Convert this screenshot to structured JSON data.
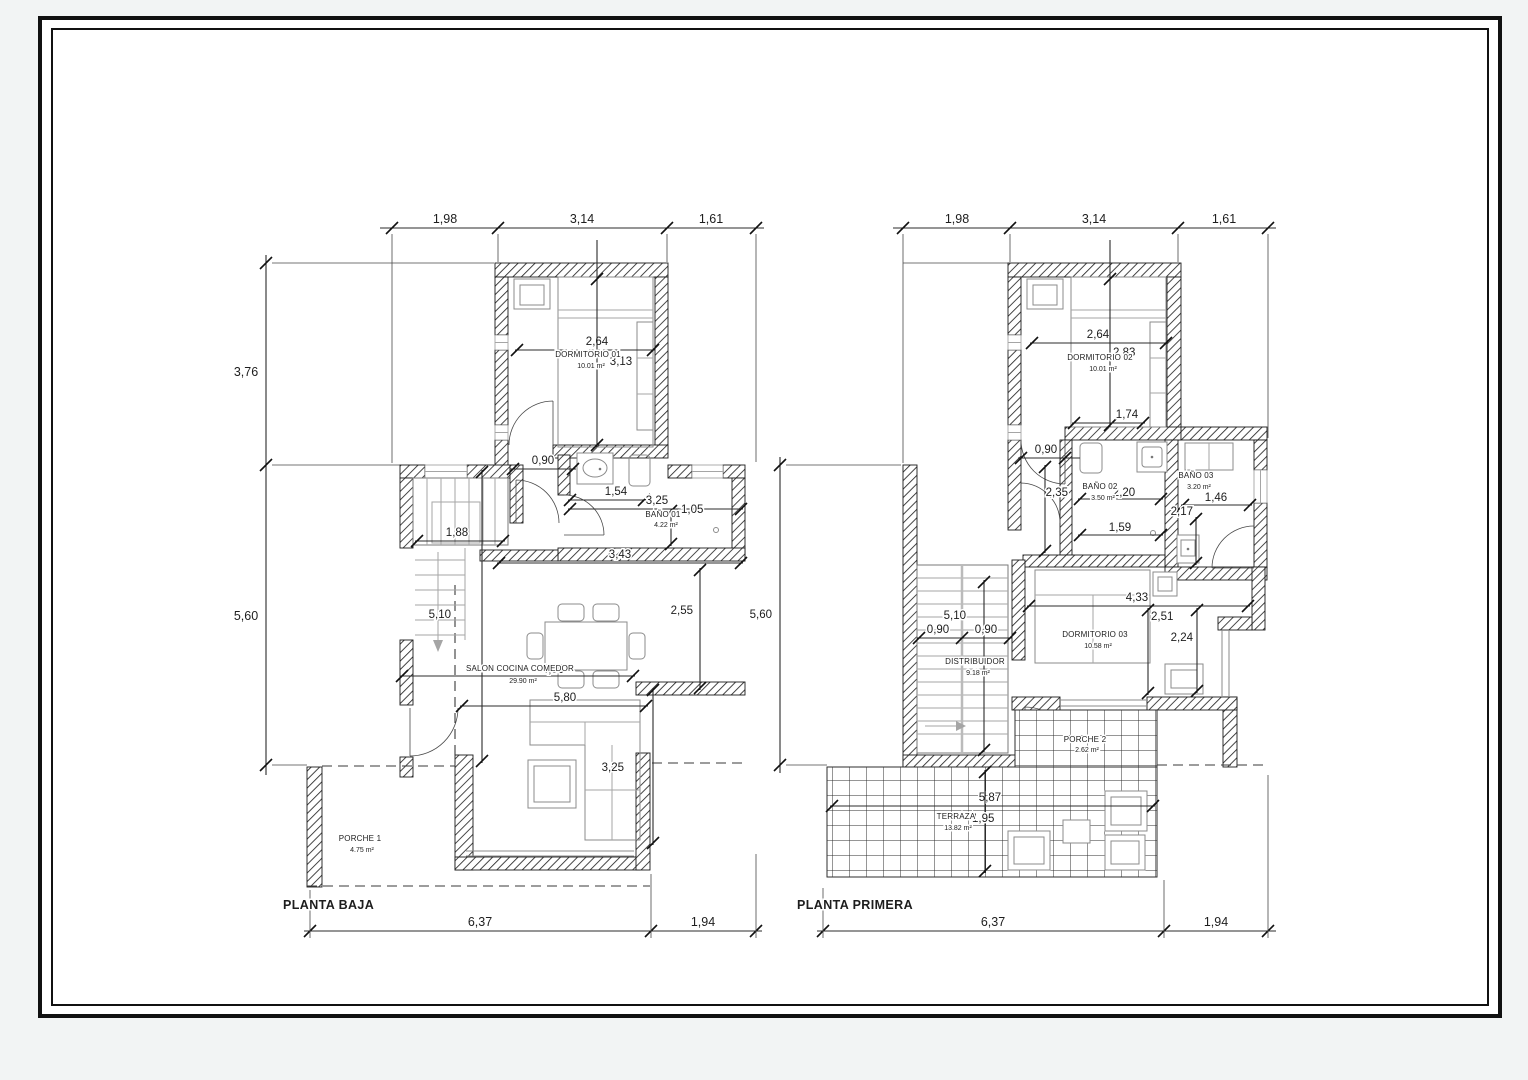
{
  "drawing": {
    "sheet_background": "#ffffff",
    "line_color": "#1a1a1a",
    "plans": [
      {
        "title": "PLANTA BAJA",
        "rooms": [
          {
            "name": "DORMITORIO 01",
            "area": "10.01 m²"
          },
          {
            "name": "BAÑO 01",
            "area": "4.22 m²"
          },
          {
            "name": "SALON COCINA COMEDOR",
            "area": "29.90 m²"
          },
          {
            "name": "PORCHE 1",
            "area": "4.75 m²"
          }
        ],
        "dims": {
          "top": [
            "1,98",
            "3,14",
            "1,61"
          ],
          "left": [
            "3,76",
            "5,60"
          ],
          "bottom": [
            "6,37",
            "1,94"
          ],
          "bed_w": "2,64",
          "bed_h": "3,13",
          "door": "0,90",
          "sink": "1,54",
          "bath_w": "3,25",
          "bath_h": "1,05",
          "stair_w": "1,88",
          "stair_h": "5,10",
          "salon_top": "3,43",
          "salon_right": "2,55",
          "salon_mid": "4,90",
          "salon_w": "5,80",
          "salon_h": "3,25"
        }
      },
      {
        "title": "PLANTA PRIMERA",
        "rooms": [
          {
            "name": "DORMITORIO 02",
            "area": "10.01 m²"
          },
          {
            "name": "BAÑO 02",
            "area": "3.50 m²"
          },
          {
            "name": "BAÑO 03",
            "area": "3.20 m²"
          },
          {
            "name": "DISTRIBUIDOR",
            "area": "9.18 m²"
          },
          {
            "name": "DORMITORIO 03",
            "area": "10.58 m²"
          },
          {
            "name": "PORCHE 2",
            "area": "2.62 m²"
          },
          {
            "name": "TERRAZA",
            "area": "13.82 m²"
          }
        ],
        "dims": {
          "top": [
            "1,98",
            "3,14",
            "1,61"
          ],
          "left": [
            "5,60"
          ],
          "bottom": [
            "6,37",
            "1,94"
          ],
          "bed_w": "2,64",
          "bed_h": "2,83",
          "bed_foot": "1,74",
          "door": "0,90",
          "hall_h": "2,35",
          "bath2_w": "2,20",
          "bath2_low": "1,59",
          "bath3_w": "1,46",
          "bath3_h": "2,17",
          "stair_h": "5,10",
          "flight1": "0,90",
          "flight2": "0,90",
          "dorm3_w": "4,33",
          "dorm3_h": "2,51",
          "dorm3_e": "2,24",
          "terraza_w": "5,87",
          "terraza_h": "1,95"
        }
      }
    ]
  }
}
